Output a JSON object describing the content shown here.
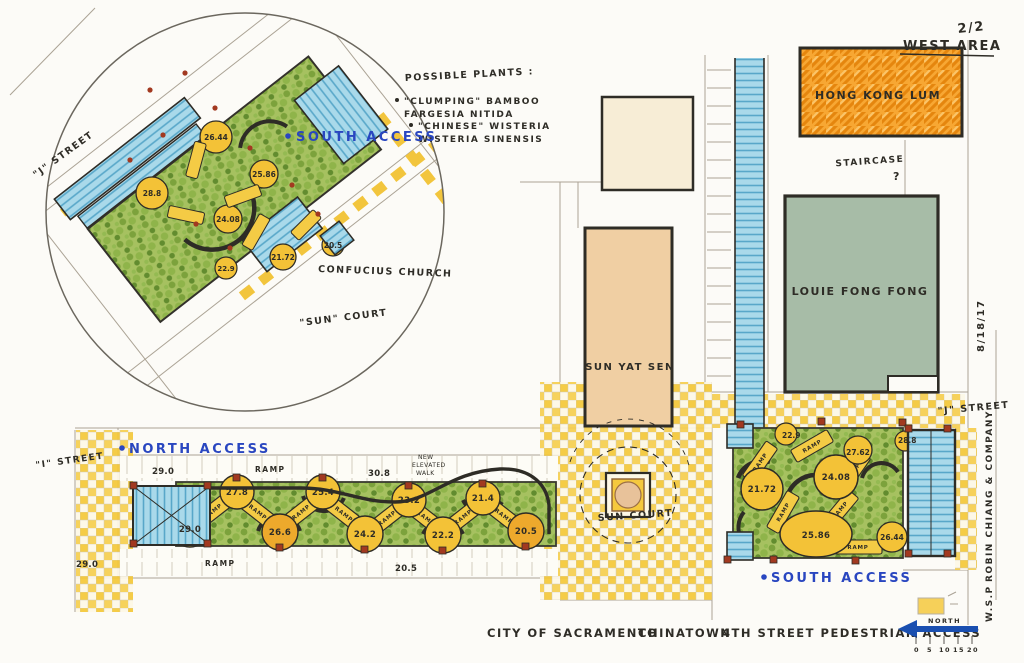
{
  "sheet": {
    "page_number": "2/2",
    "area_title": "WEST AREA",
    "date": "8/18/17",
    "firm_line1": "W.S.P",
    "firm_line2": "ROBIN CHIANG & COMPANY"
  },
  "title": {
    "parts": [
      "CITY OF SACRAMENTO",
      "CHINATOWN",
      "4TH STREET PEDESTRIAN ACCESS"
    ]
  },
  "north_arrow": {
    "label": "NORTH",
    "scale": [
      "0",
      "5",
      "10",
      "15",
      "20"
    ]
  },
  "plant_notes": {
    "heading": "POSSIBLE PLANTS :",
    "lines": [
      "\"CLUMPING\" BAMBOO",
      "FARGESIA NITIDA",
      "\"CHINESE\" WISTERIA",
      "WISTERIA SINENSIS"
    ]
  },
  "buildings": {
    "hong_kong_lum": "HONG KONG LUM",
    "louie_fong_fong": "LOUIE FONG FONG",
    "sun_yat_sen": "SUN YAT SEN"
  },
  "labels": {
    "south_access_inset": "SOUTH ACCESS",
    "north_access": "NORTH ACCESS",
    "south_access_east": "SOUTH ACCESS",
    "confucius_church": "CONFUCIUS CHURCH",
    "sun_court_inset": "\"SUN\" COURT",
    "sun_court": "SUN COURT",
    "staircase": "STAIRCASE",
    "staircase_q": "?",
    "j_street_west": "\"J\" STREET",
    "j_street_east": "\"J\" STREET",
    "i_street": "\"I\" STREET",
    "ramp": "RAMP",
    "new_note_1": "NEW",
    "new_note_2": "ELEVATED",
    "new_note_3": "WALK"
  },
  "west_walk": {
    "upper_level": "30.8",
    "lower_level": "20.5",
    "walk_start": "29.0",
    "corner_level": "29.0",
    "top": [
      "27.8",
      "25.4",
      "23.2",
      "21.4"
    ],
    "bottom": [
      "29.0",
      "26.6",
      "24.2",
      "22.2",
      "20.5"
    ]
  },
  "east_garden": {
    "elev": {
      "nw": "22.9",
      "ne": "28.8",
      "w": "21.72",
      "c": "24.08",
      "e": "27.62",
      "s": "25.86",
      "se": "26.44"
    }
  },
  "inset": {
    "elev": {
      "a": "26.44",
      "b": "25.86",
      "c": "28.8",
      "d": "24.08",
      "e": "21.72",
      "f": "22.9",
      "g": "20.5"
    }
  }
}
